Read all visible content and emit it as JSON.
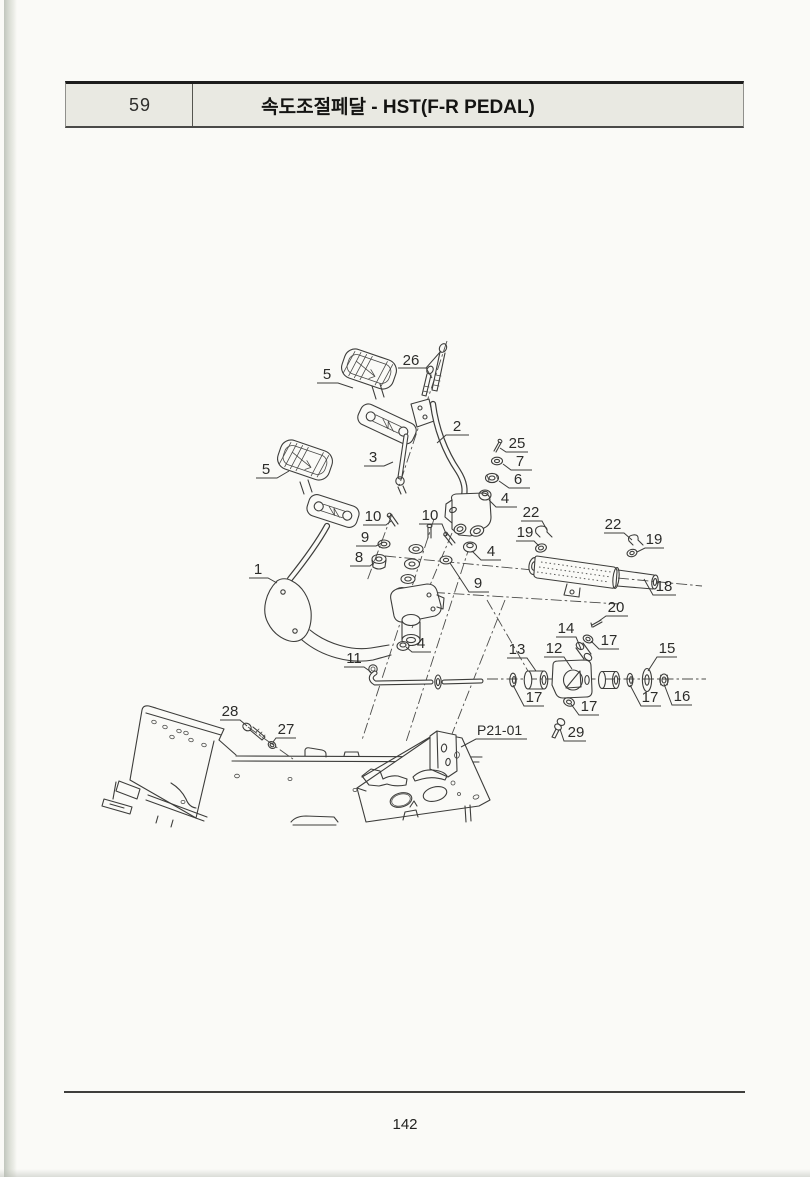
{
  "header": {
    "page_no": "59",
    "title": "속도조절페달 - HST(F-R PEDAL)"
  },
  "footer": {
    "page_number": "142"
  },
  "colors": {
    "paper": "#fafaf7",
    "header_fill": "#e9e9e2",
    "line": "#3d3d3b",
    "text": "#2c2c2a"
  },
  "diagram": {
    "figure_ref": "P21-01",
    "callouts": [
      "26",
      "5",
      "2",
      "3",
      "25",
      "7",
      "6",
      "4",
      "5",
      "10",
      "9",
      "8",
      "10",
      "22",
      "19",
      "22",
      "19",
      "9",
      "4",
      "1",
      "18",
      "20",
      "14",
      "17",
      "13",
      "12",
      "15",
      "4",
      "11",
      "17",
      "17",
      "16",
      "17",
      "28",
      "27",
      "29",
      "P21-01"
    ]
  }
}
